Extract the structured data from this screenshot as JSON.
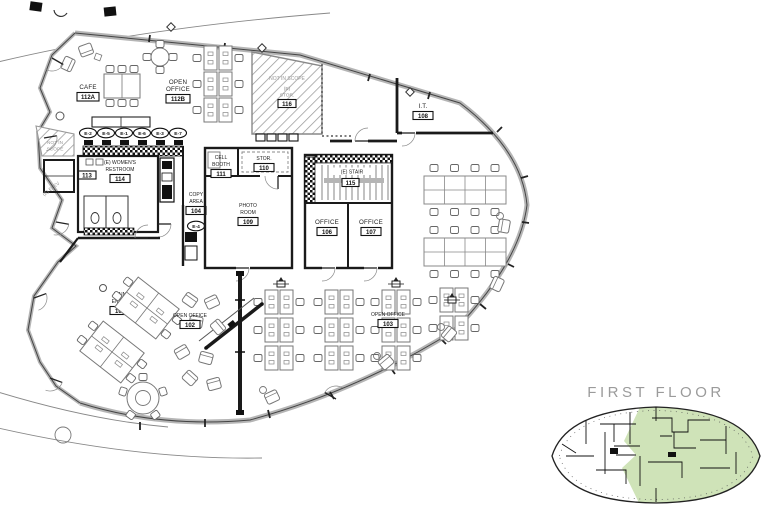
{
  "keyplan": {
    "title": "FIRST FLOOR"
  },
  "colors": {
    "highlight_green": "#cfe3b8",
    "exterior_wall_gray": "#b5b5b5",
    "keyplan_title_gray": "#9b9b9b"
  },
  "tags": {
    "kitchen_row": [
      "E-2",
      "E-5",
      "E-1",
      "E-6",
      "E-3",
      "E-7"
    ],
    "copy_area": "E-4"
  },
  "rooms": {
    "cafe": {
      "name": "CAFE",
      "number": "112A"
    },
    "open_office_top": {
      "lines": [
        "OPEN",
        "OFFICE"
      ],
      "number": "112B"
    },
    "not_in_scope_center": {
      "scope": "NOT IN SCOPE",
      "lines": [
        "(E)",
        "STOR."
      ],
      "number": "116"
    },
    "not_in_scope_left": {
      "lines": [
        "NOT IN",
        "SCOPE"
      ]
    },
    "it_room": {
      "name": "I.T.",
      "number": "108"
    },
    "womens_restroom": {
      "lines": [
        "(E) WOMEN'S",
        "RESTROOM"
      ],
      "number": "114"
    },
    "elevator": {
      "name": "(E) ELEV",
      "number": "113"
    },
    "cell_booth": {
      "lines": [
        "CELL",
        "BOOTH"
      ],
      "number": "111"
    },
    "storage": {
      "name": "STOR.",
      "number": "110"
    },
    "photo_room": {
      "lines": [
        "PHOTO",
        "ROOM"
      ],
      "number": "109"
    },
    "stair": {
      "name": "(E) STAIR",
      "number": "115"
    },
    "office_a": {
      "name": "OFFICE",
      "number": "106"
    },
    "office_b": {
      "name": "OFFICE",
      "number": "107"
    },
    "copy_area": {
      "lines": [
        "COPY",
        "AREA"
      ],
      "number": "104"
    },
    "main_entry": {
      "lines": [
        "MAIN",
        "ENTRY"
      ],
      "number": "101"
    },
    "open_office_west": {
      "name": "OPEN OFFICE",
      "number": "102"
    },
    "open_office_south": {
      "name": "OPEN OFFICE",
      "number": "103"
    }
  }
}
